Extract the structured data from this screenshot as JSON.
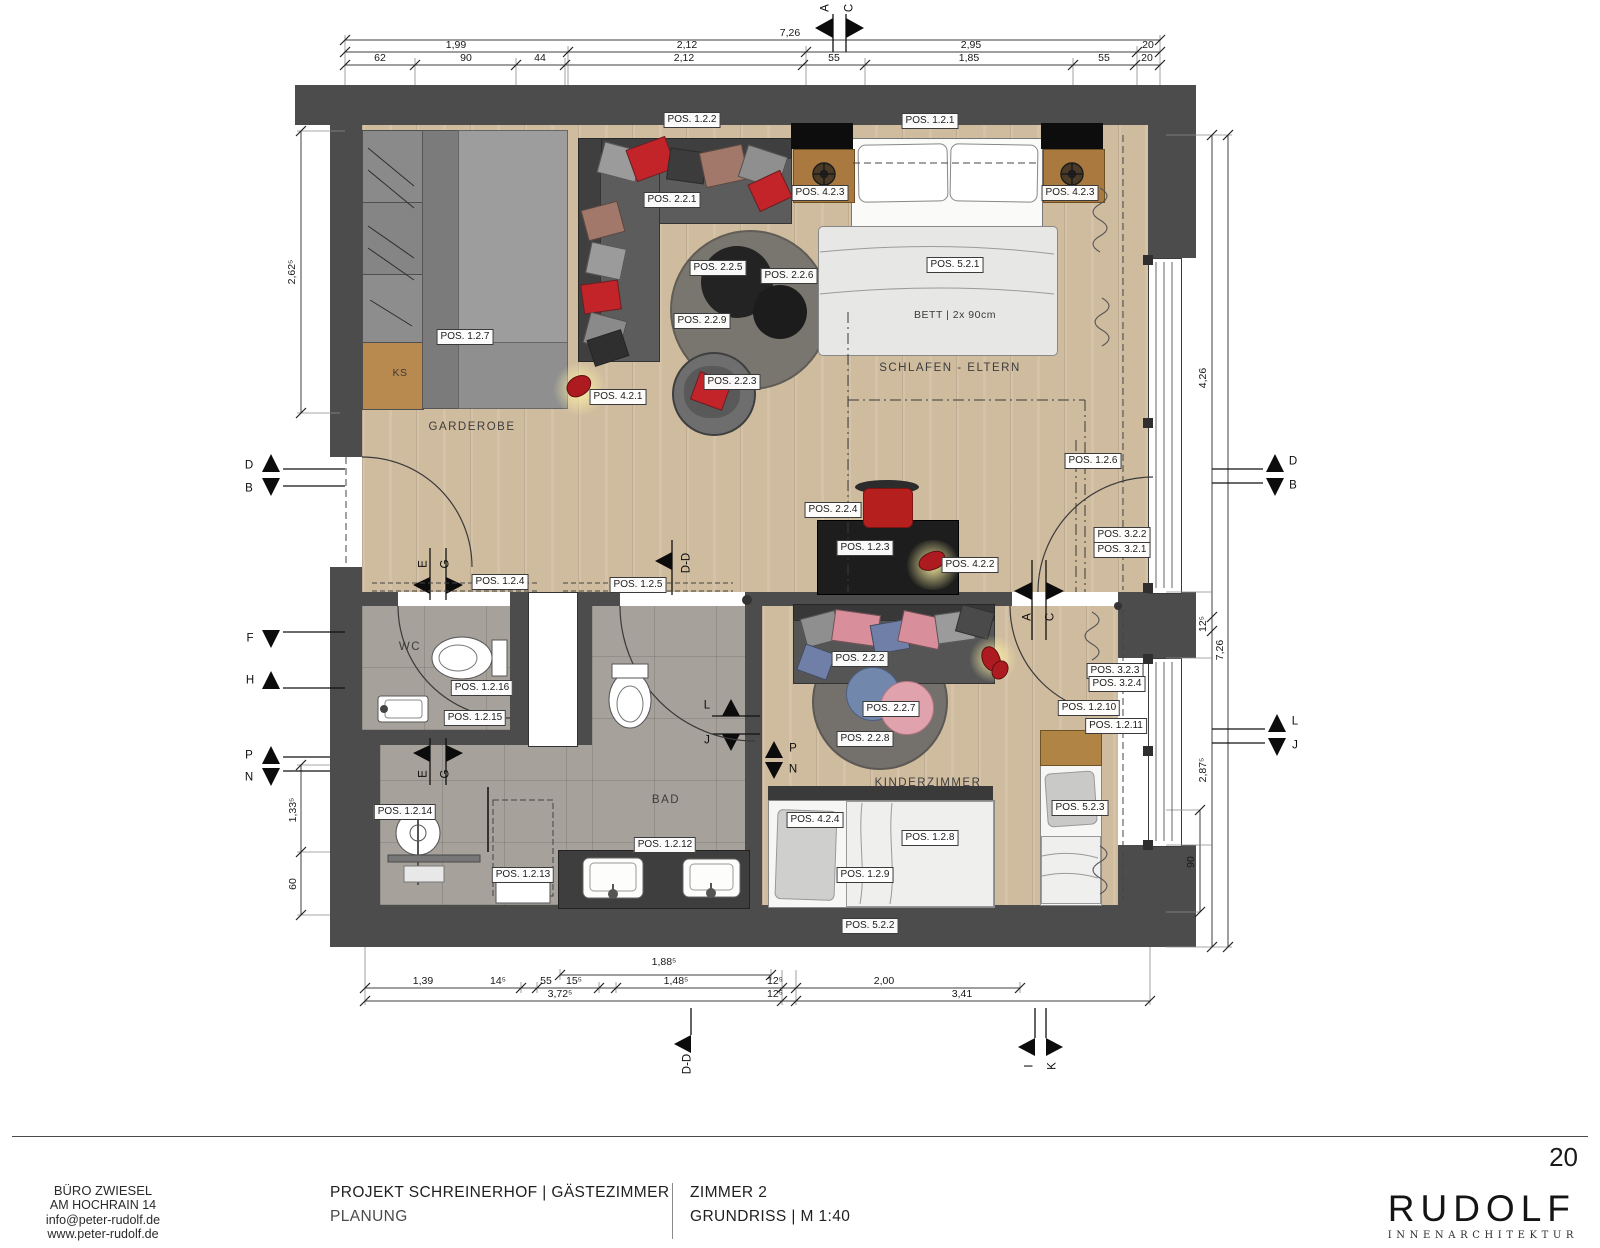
{
  "page": {
    "number": "20"
  },
  "footer": {
    "office_lines": [
      "BÜRO ZWIESEL",
      "AM HOCHRAIN 14",
      "info@peter-rudolf.de",
      "www.peter-rudolf.de"
    ],
    "project_title": "PROJEKT SCHREINERHOF | GÄSTEZIMMER",
    "project_phase": "PLANUNG",
    "sheet_title": "ZIMMER 2",
    "sheet_subtitle": "GRUNDRISS | M 1:40",
    "logo": {
      "name": "RUDOLF",
      "sub": "INNENARCHITEKTUR"
    }
  },
  "plan": {
    "rooms": [
      {
        "text": "GARDEROBE",
        "x": 472,
        "y": 427
      },
      {
        "text": "SCHLAFEN - ELTERN",
        "x": 950,
        "y": 368
      },
      {
        "text": "WC",
        "x": 410,
        "y": 647
      },
      {
        "text": "BAD",
        "x": 666,
        "y": 800
      },
      {
        "text": "KINDERZIMMER",
        "x": 928,
        "y": 783
      }
    ],
    "texts": [
      {
        "text": "BETT | 2x 90cm",
        "x": 955,
        "y": 315
      },
      {
        "text": "KS",
        "x": 400,
        "y": 373
      }
    ],
    "pos_labels": [
      {
        "text": "POS. 1.2.2",
        "x": 692,
        "y": 120
      },
      {
        "text": "POS. 1.2.1",
        "x": 930,
        "y": 121
      },
      {
        "text": "POS. 2.2.1",
        "x": 672,
        "y": 200
      },
      {
        "text": "POS. 4.2.3",
        "x": 820,
        "y": 193
      },
      {
        "text": "POS. 4.2.3",
        "x": 1070,
        "y": 193
      },
      {
        "text": "POS. 5.2.1",
        "x": 955,
        "y": 265
      },
      {
        "text": "POS. 2.2.5",
        "x": 718,
        "y": 268
      },
      {
        "text": "POS. 2.2.6",
        "x": 789,
        "y": 276
      },
      {
        "text": "POS. 2.2.9",
        "x": 702,
        "y": 321
      },
      {
        "text": "POS. 1.2.7",
        "x": 465,
        "y": 337
      },
      {
        "text": "POS. 2.2.3",
        "x": 732,
        "y": 382
      },
      {
        "text": "POS. 4.2.1",
        "x": 618,
        "y": 397
      },
      {
        "text": "POS. 1.2.6",
        "x": 1093,
        "y": 461
      },
      {
        "text": "POS. 2.2.4",
        "x": 833,
        "y": 510
      },
      {
        "text": "POS. 1.2.3",
        "x": 865,
        "y": 548
      },
      {
        "text": "POS. 4.2.2",
        "x": 970,
        "y": 565
      },
      {
        "text": "POS. 3.2.2",
        "x": 1122,
        "y": 535
      },
      {
        "text": "POS. 3.2.1",
        "x": 1122,
        "y": 550
      },
      {
        "text": "POS. 1.2.4",
        "x": 500,
        "y": 582
      },
      {
        "text": "POS. 1.2.5",
        "x": 638,
        "y": 585
      },
      {
        "text": "POS. 1.2.16",
        "x": 482,
        "y": 688
      },
      {
        "text": "POS. 1.2.15",
        "x": 475,
        "y": 718
      },
      {
        "text": "POS. 1.2.14",
        "x": 405,
        "y": 812
      },
      {
        "text": "POS. 1.2.13",
        "x": 523,
        "y": 875
      },
      {
        "text": "POS. 1.2.12",
        "x": 665,
        "y": 845
      },
      {
        "text": "POS. 2.2.2",
        "x": 860,
        "y": 659
      },
      {
        "text": "POS. 2.2.7",
        "x": 891,
        "y": 709
      },
      {
        "text": "POS. 2.2.8",
        "x": 865,
        "y": 739
      },
      {
        "text": "POS. 3.2.3",
        "x": 1115,
        "y": 671
      },
      {
        "text": "POS. 3.2.4",
        "x": 1117,
        "y": 684
      },
      {
        "text": "POS. 1.2.10",
        "x": 1089,
        "y": 708
      },
      {
        "text": "POS. 1.2.11",
        "x": 1116,
        "y": 726
      },
      {
        "text": "POS. 4.2.4",
        "x": 815,
        "y": 820
      },
      {
        "text": "POS. 1.2.8",
        "x": 930,
        "y": 838
      },
      {
        "text": "POS. 1.2.9",
        "x": 865,
        "y": 875
      },
      {
        "text": "POS. 5.2.2",
        "x": 870,
        "y": 926
      },
      {
        "text": "POS. 5.2.3",
        "x": 1080,
        "y": 808
      }
    ],
    "dims": [
      {
        "text": "7,26",
        "x": 790,
        "y": 33
      },
      {
        "text": "1,99",
        "x": 456,
        "y": 45
      },
      {
        "text": "2,12",
        "x": 687,
        "y": 45
      },
      {
        "text": "2,95",
        "x": 971,
        "y": 45
      },
      {
        "text": "20",
        "x": 1148,
        "y": 45
      },
      {
        "text": "62",
        "x": 380,
        "y": 58
      },
      {
        "text": "90",
        "x": 466,
        "y": 58
      },
      {
        "text": "44",
        "x": 540,
        "y": 58
      },
      {
        "text": "2,12",
        "x": 684,
        "y": 58
      },
      {
        "text": "55",
        "x": 834,
        "y": 58
      },
      {
        "text": "1,85",
        "x": 969,
        "y": 58
      },
      {
        "text": "55",
        "x": 1104,
        "y": 58
      },
      {
        "text": "20",
        "x": 1147,
        "y": 58
      },
      {
        "text": "2,62⁵",
        "x": 292,
        "y": 272,
        "rot": -90
      },
      {
        "text": "1,33⁵",
        "x": 293,
        "y": 810,
        "rot": -90
      },
      {
        "text": "60",
        "x": 293,
        "y": 884,
        "rot": -90
      },
      {
        "text": "4,26",
        "x": 1203,
        "y": 378,
        "rot": -90
      },
      {
        "text": "12⁵",
        "x": 1203,
        "y": 624,
        "rot": -90
      },
      {
        "text": "2,87⁵",
        "x": 1203,
        "y": 770,
        "rot": -90
      },
      {
        "text": "7,26",
        "x": 1220,
        "y": 650,
        "rot": -90
      },
      {
        "text": "90",
        "x": 1191,
        "y": 862,
        "rot": -90
      },
      {
        "text": "1,88⁵",
        "x": 664,
        "y": 962
      },
      {
        "text": "1,39",
        "x": 423,
        "y": 981
      },
      {
        "text": "14⁵",
        "x": 498,
        "y": 981
      },
      {
        "text": "55",
        "x": 546,
        "y": 981
      },
      {
        "text": "15⁵",
        "x": 574,
        "y": 981
      },
      {
        "text": "1,48⁵",
        "x": 676,
        "y": 981
      },
      {
        "text": "12⁵",
        "x": 775,
        "y": 981
      },
      {
        "text": "2,00",
        "x": 884,
        "y": 981
      },
      {
        "text": "3,72⁵",
        "x": 560,
        "y": 994
      },
      {
        "text": "12⁵",
        "x": 775,
        "y": 994
      },
      {
        "text": "3,41",
        "x": 962,
        "y": 994
      }
    ],
    "markers": [
      {
        "text": "A",
        "x": 826,
        "y": 8,
        "rot": -90
      },
      {
        "text": "C",
        "x": 850,
        "y": 8,
        "rot": -90
      },
      {
        "text": "D",
        "x": 249,
        "y": 466
      },
      {
        "text": "B",
        "x": 249,
        "y": 489
      },
      {
        "text": "F",
        "x": 250,
        "y": 639
      },
      {
        "text": "H",
        "x": 250,
        "y": 681
      },
      {
        "text": "P",
        "x": 249,
        "y": 756
      },
      {
        "text": "N",
        "x": 249,
        "y": 778
      },
      {
        "text": "D",
        "x": 1293,
        "y": 462
      },
      {
        "text": "B",
        "x": 1293,
        "y": 486
      },
      {
        "text": "L",
        "x": 1295,
        "y": 722
      },
      {
        "text": "J",
        "x": 1295,
        "y": 746
      },
      {
        "text": "E",
        "x": 424,
        "y": 564,
        "rot": -90
      },
      {
        "text": "G",
        "x": 446,
        "y": 564,
        "rot": -90
      },
      {
        "text": "E",
        "x": 424,
        "y": 774,
        "rot": -90
      },
      {
        "text": "G",
        "x": 446,
        "y": 774,
        "rot": -90
      },
      {
        "text": "A",
        "x": 1028,
        "y": 617,
        "rot": -90
      },
      {
        "text": "C",
        "x": 1051,
        "y": 617,
        "rot": -90
      },
      {
        "text": "L",
        "x": 707,
        "y": 706
      },
      {
        "text": "J",
        "x": 707,
        "y": 741
      },
      {
        "text": "P",
        "x": 793,
        "y": 749
      },
      {
        "text": "N",
        "x": 793,
        "y": 770
      },
      {
        "text": "D-D",
        "x": 687,
        "y": 563,
        "rot": -90
      },
      {
        "text": "D-D",
        "x": 688,
        "y": 1064,
        "rot": -90
      },
      {
        "text": "I",
        "x": 1030,
        "y": 1066,
        "rot": -90
      },
      {
        "text": "K",
        "x": 1053,
        "y": 1066,
        "rot": -90
      }
    ]
  }
}
